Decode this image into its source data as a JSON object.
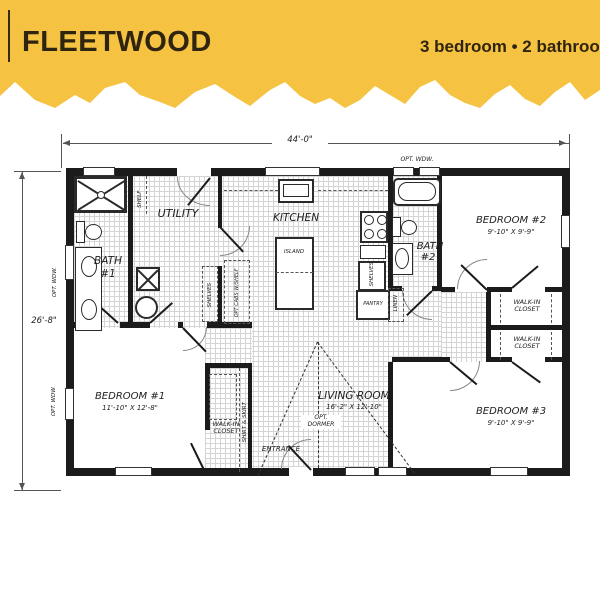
{
  "header": {
    "title": "FLEETWOOD",
    "subtitle": "3 bedroom  •  2 bathroom",
    "band_color": "#F5C242",
    "text_color": "#2F2410"
  },
  "plan": {
    "dimensions": {
      "width": "44'-0\"",
      "depth": "26'-8\""
    },
    "rooms": {
      "utility": "UTILITY",
      "kitchen": "KITCHEN",
      "living": {
        "name": "LIVING ROOM",
        "dims": "16'-2\" X 12'-10\""
      },
      "bath1": {
        "line1": "BATH",
        "line2": "#1"
      },
      "bath2": {
        "line1": "BATH",
        "line2": "#2"
      },
      "bedroom1": {
        "name": "BEDROOM #1",
        "dims": "11'-10\" X 12'-8\""
      },
      "bedroom2": {
        "name": "BEDROOM #2",
        "dims": "9'-10\" X 9'-9\""
      },
      "bedroom3": {
        "name": "BEDROOM #3",
        "dims": "9'-10\" X 9'-9\""
      }
    },
    "labels": {
      "island": "ISLAND",
      "pantry": "PANTRY",
      "linen": "LINEN",
      "shelf": "SHELF",
      "shelves": "SHELVES",
      "opt_cabs": "OPT CABS W/SHELF",
      "walk_in_closet": "WALK-IN\nCLOSET",
      "shirt_skirt": "SHIRT & SKIRT",
      "entrance": "ENTRANCE",
      "opt_dormer": "OPT.\nDORMER",
      "opt_window": "OPT. WDW."
    }
  }
}
